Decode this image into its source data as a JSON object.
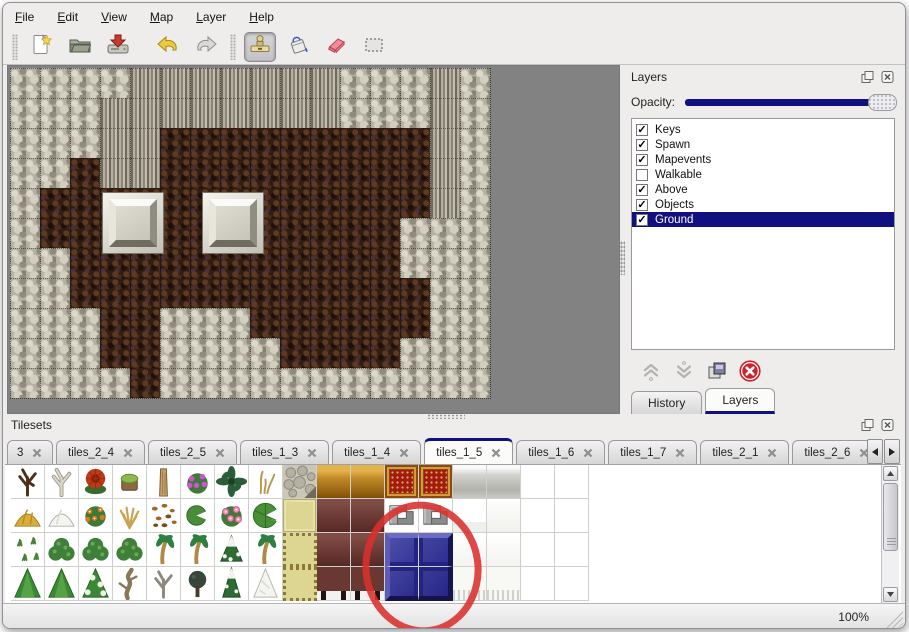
{
  "menu_bar": {
    "items": [
      "File",
      "Edit",
      "View",
      "Map",
      "Layer",
      "Help"
    ]
  },
  "toolbar": {
    "groups": [
      {
        "buttons": [
          {
            "name": "new-file",
            "icon": "new"
          },
          {
            "name": "open-map",
            "icon": "open"
          },
          {
            "name": "save-map",
            "icon": "save"
          }
        ]
      },
      {
        "buttons": [
          {
            "name": "undo",
            "icon": "undo"
          },
          {
            "name": "redo",
            "icon": "redo"
          }
        ]
      },
      {
        "buttons": [
          {
            "name": "stamp-tool",
            "icon": "stamp",
            "active": true
          },
          {
            "name": "fill-tool",
            "icon": "fill"
          },
          {
            "name": "eraser-tool",
            "icon": "eraser"
          },
          {
            "name": "rect-select-tool",
            "icon": "select"
          }
        ]
      }
    ]
  },
  "map_view": {
    "tile_size": 30,
    "tile_legend": {
      "S": "rock",
      "C": "cliff",
      "F": "floor"
    },
    "rows": [
      "SSSSCCCCCCCSSSCS",
      "SSSCCCCCCCCSSSCS",
      "SSSCCFFFFFFFFFCS",
      "SSFCCFFFFFFFFFCS",
      "SFFFFFFFFFFFFFCS",
      "SFFFFFFFFFFFFSSS",
      "SSFFFFFFFFFFFSSS",
      "SSFFFFFFFFFFFFSS",
      "SSSFFSSSFFFFFFSS",
      "SSSFFSSSSFFFFSSS",
      "SSSSFSSSSSSSSSSS"
    ],
    "pillars": [
      {
        "left": 92,
        "top": 124
      },
      {
        "left": 192,
        "top": 124
      }
    ]
  },
  "layers_panel": {
    "title": "Layers",
    "opacity_label": "Opacity:",
    "opacity_percent": 100,
    "layers": [
      {
        "name": "Keys",
        "checked": true,
        "selected": false
      },
      {
        "name": "Spawn",
        "checked": true,
        "selected": false
      },
      {
        "name": "Mapevents",
        "checked": true,
        "selected": false
      },
      {
        "name": "Walkable",
        "checked": false,
        "selected": false
      },
      {
        "name": "Above",
        "checked": true,
        "selected": false
      },
      {
        "name": "Objects",
        "checked": true,
        "selected": false
      },
      {
        "name": "Ground",
        "checked": true,
        "selected": true
      }
    ],
    "buttons": [
      {
        "name": "move-layer-up",
        "icon": "up",
        "enabled": false
      },
      {
        "name": "move-layer-down",
        "icon": "down",
        "enabled": false
      },
      {
        "name": "duplicate-layer",
        "icon": "copy",
        "enabled": true
      },
      {
        "name": "delete-layer",
        "icon": "delete",
        "enabled": true
      }
    ],
    "tabs": [
      {
        "label": "History",
        "active": false
      },
      {
        "label": "Layers",
        "active": true
      }
    ]
  },
  "tilesets_panel": {
    "title": "Tilesets",
    "tabs": [
      {
        "label": "3",
        "active": false,
        "clipped": true
      },
      {
        "label": "tiles_2_4",
        "active": false
      },
      {
        "label": "tiles_2_5",
        "active": false
      },
      {
        "label": "tiles_1_3",
        "active": false
      },
      {
        "label": "tiles_1_4",
        "active": false
      },
      {
        "label": "tiles_1_5",
        "active": true
      },
      {
        "label": "tiles_1_6",
        "active": false
      },
      {
        "label": "tiles_1_7",
        "active": false
      },
      {
        "label": "tiles_2_1",
        "active": false
      },
      {
        "label": "tiles_2_6",
        "active": false
      }
    ],
    "cell_size": 34,
    "grid": [
      [
        "tree_bare_dark",
        "tree_bare_white",
        "flower_red",
        "stump",
        "trunk_tall",
        "flowers_purple",
        "palm_dark",
        "sprig_dry",
        "stone_pav",
        "gold_top",
        "gold_top",
        "carpet_red",
        "carpet_red",
        "silver_top",
        "silver_top",
        "empty",
        "empty"
      ],
      [
        "mound_hay",
        "mound_snow",
        "flowers_orange",
        "bush_dry",
        "leaves_scatter",
        "lilypad",
        "flowers_pink",
        "lilypad_big",
        "gold_tile",
        "maroon_block",
        "maroon_block",
        "bracket_gray",
        "bracket_gray",
        "curtain_white",
        "white_block",
        "empty",
        "empty"
      ],
      [
        "sprigs_small",
        "bush_green",
        "bush_green",
        "bush_green",
        "palm_tree",
        "palm_tree",
        "pine_snow",
        "palm_tree",
        "gold_tile_pat",
        "maroon_block",
        "maroon_block",
        "blue_tl",
        "blue_tr",
        "curtain_tl",
        "curtain_tr",
        "empty",
        "empty"
      ],
      [
        "tree_cone",
        "tree_cone",
        "tree_cone_snow",
        "tree_twisted",
        "tree_bare_gray",
        "tree_dark",
        "pine_snow_tall",
        "tree_snow_white",
        "gold_tile_pat",
        "maroon_legs",
        "maroon_legs",
        "blue_bl",
        "blue_br",
        "curtain_bl",
        "curtain_br",
        "empty",
        "empty"
      ]
    ],
    "annotation": {
      "shape": "ellipse",
      "color": "#d9302e",
      "target": "blue-tile"
    }
  },
  "status_bar": {
    "zoom_level": "100%"
  },
  "colors": {
    "accent": "#10107e",
    "canvas_gray": "#828282",
    "annotation_red": "#d9302e"
  }
}
